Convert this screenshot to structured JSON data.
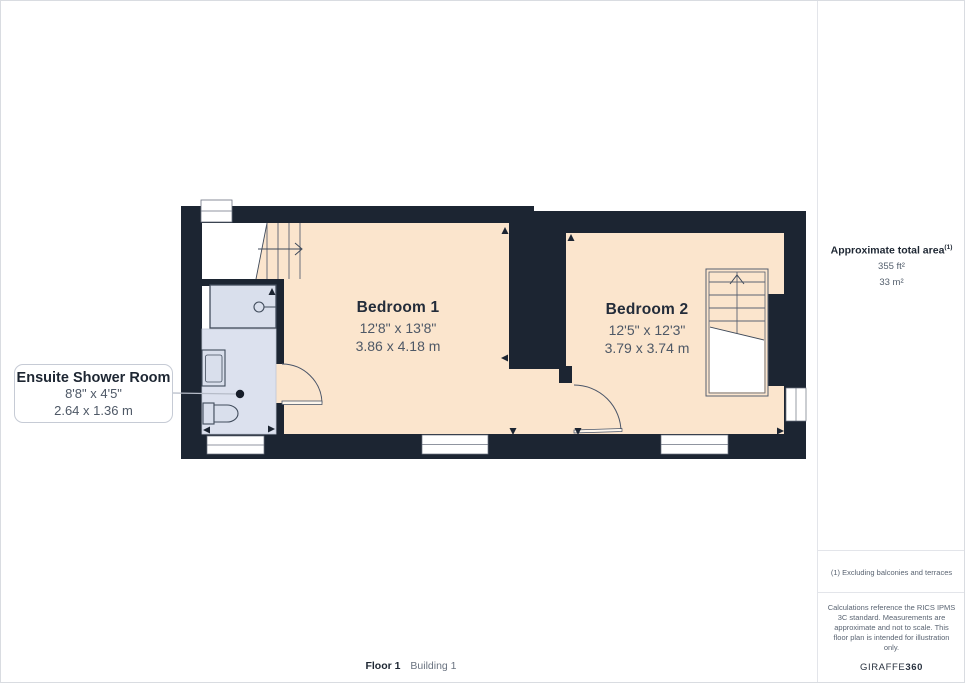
{
  "plan": {
    "rooms": [
      {
        "name": "Bedroom 1",
        "imperial": "12'8\" x 13'8\"",
        "metric": "3.86 x 4.18 m"
      },
      {
        "name": "Bedroom 2",
        "imperial": "12'5\" x 12'3\"",
        "metric": "3.79 x 3.74 m"
      },
      {
        "name": "Ensuite Shower Room",
        "imperial": "8'8\" x 4'5\"",
        "metric": "2.64 x 1.36 m"
      }
    ]
  },
  "sidebar": {
    "total_area_label": "Approximate total area",
    "total_area_footnote_marker": "(1)",
    "total_area_ft": "355 ft²",
    "total_area_m": "33 m²",
    "footnote": "(1) Excluding balconies and terraces",
    "disclaimer": "Calculations reference the RICS IPMS 3C standard. Measurements are approximate and not to scale. This floor plan is intended for illustration only.",
    "brand_name": "GIRAFFE",
    "brand_suffix": "360"
  },
  "footer": {
    "floor_label": "Floor 1",
    "building_label": "Building 1"
  },
  "colors": {
    "wall": "#1c2532",
    "room_floor": "#fbe5cd",
    "ensuite_floor": "#dce1ee",
    "fixture_stroke": "#414c5c"
  }
}
